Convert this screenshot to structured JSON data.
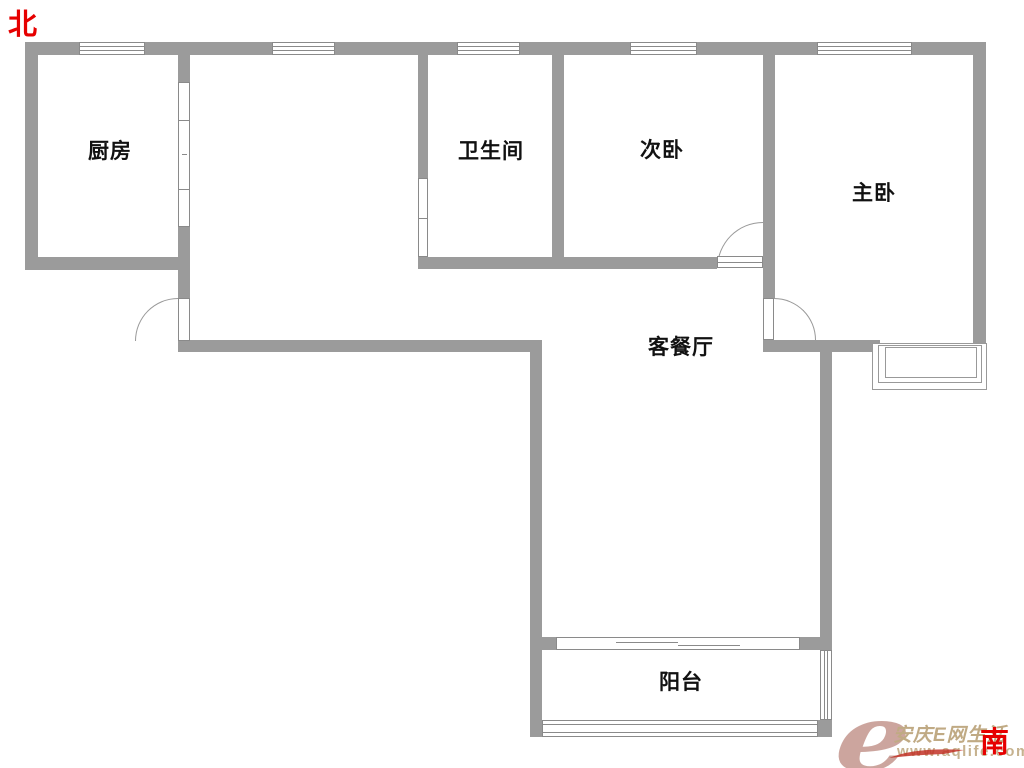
{
  "compass": {
    "north": "北",
    "south": "南"
  },
  "rooms": {
    "kitchen": "厨房",
    "bathroom": "卫生间",
    "second_bedroom": "次卧",
    "master_bedroom": "主卧",
    "living_dining": "客餐厅",
    "balcony": "阳台"
  },
  "watermark": {
    "logo": "e",
    "title": "安庆E网生活",
    "url": "www.aqlife.com"
  },
  "colors": {
    "wall": "#9b9b9b",
    "window_line": "#8a8a8a",
    "arc": "#999999",
    "label": "#111111",
    "compass_red": "#e60000",
    "watermark_logo": "#c4968e",
    "watermark_text": "#c0aa84",
    "watermark_url": "#c6b28f"
  }
}
